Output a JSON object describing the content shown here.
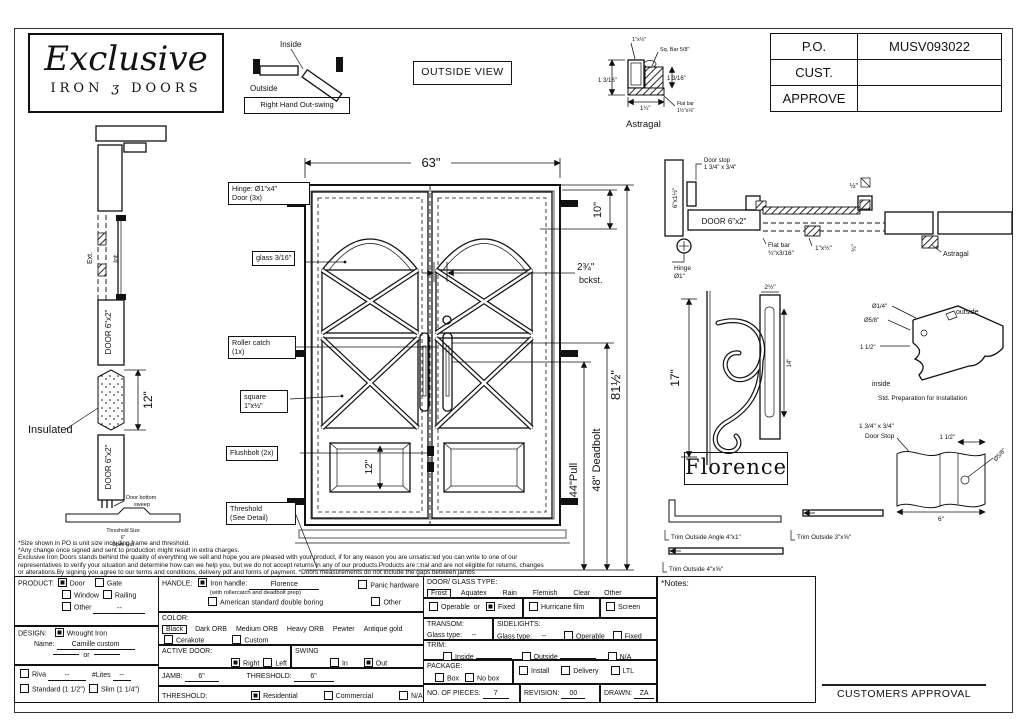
{
  "logo": {
    "name": "Exclusive",
    "iron": "IRON",
    "amp": "ʒ",
    "doors": "DOORS"
  },
  "swing": {
    "inside": "Inside",
    "outside": "Outside",
    "caption": "Right Hand Out-swing"
  },
  "outside_view": "OUTSIDE VIEW",
  "po": {
    "r0l": "P.O.",
    "r0v": "MUSV093022",
    "r1l": "CUST.",
    "r1v": "",
    "r2l": "APPROVE",
    "r2v": ""
  },
  "ast": {
    "t1": "1\"x½\"",
    "t2": "Sq. Bar 5/8\"",
    "l": "1 3/16\"",
    "r": "1 3/16\"",
    "b": "1¼\"",
    "f1": "Flat bar",
    "f2": "1½\"x⅛\"",
    "cap": "Astragal"
  },
  "ls": {
    "ext": "Ext.",
    "int": "Int.",
    "d1": "DOOR 6\"x2\"",
    "d2": "DOOR 6\"x2\"",
    "dim": "12\"",
    "ins": "Insulated",
    "sw1": "Door bottom",
    "sw2": "sweep",
    "th1": "Threshold Size",
    "th2": "6\"",
    "th3": "Open Out"
  },
  "mv": {
    "hinge1": "Hinge: Ø1\"x4\"",
    "hinge2": "Door (3x)",
    "glass": "glass 3/16\"",
    "rc1": "Roller catch",
    "rc2": "(1x)",
    "sq1": "square",
    "sq2": "1\"x½\"",
    "fb": "Flushbolt (2x)",
    "t1": "Threshold",
    "t2": "(See Detail)",
    "w": "63\"",
    "ten": "10\"",
    "bck1": "2¾\"",
    "bck2": "bckst.",
    "twelve": "12\"",
    "pull": "44\"Pull",
    "db": "48\" Deadbolt",
    "h": "81½\""
  },
  "rs": {
    "stop1": "Door stop",
    "stop2": "1 3/4\" x 3/4\"",
    "jamb": "6\"x1½\"",
    "door": "DOOR 6\"x2\"",
    "hinge1": "Hinge",
    "hinge2": "Ø1\"",
    "fb1": "Flat bar",
    "fb2": "¾\"x3/16\"",
    "bar": "1\"x½\"",
    "q34": "¾\"",
    "half": "½\"",
    "astr": "Astragal"
  },
  "fl": {
    "h": "17\"",
    "w": "2½\"",
    "bar": "14\"",
    "name": "Florence"
  },
  "prep": {
    "d1": "Ø1/4\"",
    "d2": "Ø5/8\"",
    "d3": "1 1/2\"",
    "out": "outside",
    "in": "inside",
    "cap": "Std. Preparation for Installation"
  },
  "sd": {
    "l1": "1 3/4\" x 3/4\"",
    "l2": "Door Stop",
    "w": "1 1/2\"",
    "d": "Ø5/8\"",
    "b": "6\""
  },
  "tr": {
    "a": "Trim Outside Angle 4\"x1\"",
    "b": "Trim Outside 3\"x⅝\"",
    "c": "Trim Outside 4\"x⅝\""
  },
  "disc": {
    "l1": "*Size shown in PO is unit size including frame and threshold.",
    "l2": "*Any change once signed and sent to production might result in extra charges.",
    "l3": "Exclusive Iron Doors stands behind the quality of everything we sell and hope you are pleased with your product, if for any reason you are unsatis□ed you can write to one of our",
    "l4": "representatives to verify your situation and determine how can we help you, but we do not accept returns in any of our products.Products are □nal and are not eligible for returns, changes",
    "l5": "or alterations.By signing you agree to our terms and conditions, delivery pdf and forms of payment. *Doors measurements do not include the gaps between jambs"
  },
  "form": {
    "product": {
      "t": "PRODUCT:",
      "door": "Door",
      "gate": "Gate",
      "window": "Window",
      "railing": "Railing",
      "other": "Other",
      "oval": "--"
    },
    "design": {
      "t": "DESIGN:",
      "w": "Wrought Iron",
      "nl": "Name:",
      "nv": "Camille custom",
      "or": "or"
    },
    "riva": {
      "r": "Riva",
      "rv": "--",
      "l": "#Lites",
      "lv": "--",
      "std": "Standard (1 1/2\")",
      "slim": "Slim (1 1/4\")"
    },
    "handle": {
      "t": "HANDLE:",
      "iron": "Iron handle:",
      "iv": "Florence",
      "sub": "(with rollercatch and deadbolt prep)",
      "panic": "Panic hardware",
      "am": "American standard double boring",
      "other": "Other"
    },
    "color": {
      "t": "COLOR:",
      "black": "Black",
      "o1": "Dark ORB",
      "o2": "Medium ORB",
      "o3": "Heavy ORB",
      "o4": "Pewter",
      "o5": "Antique gold",
      "cer": "Cerakote",
      "cus": "Custom"
    },
    "active": {
      "t": "ACTIVE DOOR:",
      "r": "Right",
      "l": "Left",
      "s": "SWING",
      "in": "In",
      "out": "Out"
    },
    "jamb": {
      "t": "JAMB:",
      "v": "6\"",
      "t2": "THRESHOLD:",
      "v2": "6\""
    },
    "thr": {
      "t": "THRESHOLD:",
      "res": "Residential",
      "com": "Commercial",
      "na": "N/A"
    },
    "glass": {
      "t": "DOOR/ GLASS TYPE:",
      "frost": "Frost",
      "o1": "Aquatex",
      "o2": "Rain",
      "o3": "Flemish",
      "o4": "Clear",
      "o5": "Other"
    },
    "glaz": {
      "op": "Operable",
      "or": "or",
      "fx": "Fixed",
      "hf": "Hurricane film",
      "sc": "Screen"
    },
    "transom": {
      "t": "TRANSOM:",
      "g": "Glass type:",
      "v": "--"
    },
    "side": {
      "t": "SIDELIGHTS:",
      "g": "Glass type:",
      "v": "--",
      "op": "Operable",
      "fx": "Fixed"
    },
    "trim": {
      "t": "TRIM:",
      "in": "Inside",
      "out": "Outside",
      "na": "N/A"
    },
    "pkg": {
      "t": "PACKAGE:",
      "box": "Box",
      "nobox": "No box",
      "ins": "Install",
      "del": "Delivery",
      "ltl": "LTL"
    },
    "pieces": {
      "t": "NO. OF PIECES:",
      "v": "7",
      "r": "REVISION:",
      "rv": "00",
      "d": "DRAWN:",
      "dv": "ZA"
    },
    "notes": {
      "t": "*Notes:"
    }
  },
  "approval": "CUSTOMERS APPROVAL"
}
